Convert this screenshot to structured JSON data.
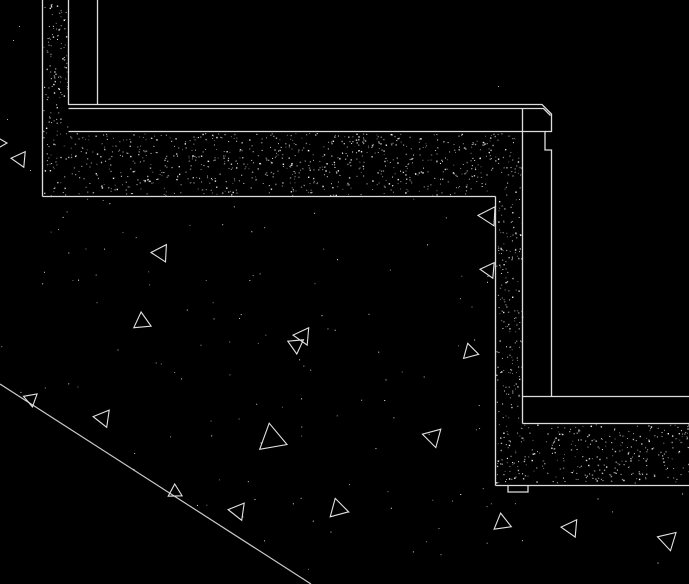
{
  "meta": {
    "app": "cad-detail-drawing",
    "description": "Concrete parapet / stepped retaining wall section detail on black CAD background",
    "canvas": {
      "width": 689,
      "height": 584
    }
  },
  "colors": {
    "background": "#000000",
    "line": "#dcdcdc",
    "grade_line": "#c9c9c9",
    "triangle": "#e2e2e2",
    "stipple": "#ffffff"
  },
  "drawing": {
    "seed": 1337,
    "outlines": [
      {
        "name": "wall-outer-face",
        "pts": [
          [
            42.5,
            0
          ],
          [
            42.5,
            196.5
          ]
        ]
      },
      {
        "name": "wall-inner-face",
        "pts": [
          [
            68.5,
            0
          ],
          [
            68.5,
            105
          ]
        ]
      },
      {
        "name": "finish-face-line",
        "pts": [
          [
            97.5,
            0
          ],
          [
            97.5,
            105
          ]
        ]
      },
      {
        "name": "coping-top-outer",
        "pts": [
          [
            68.5,
            104.5
          ],
          [
            542,
            104.5
          ],
          [
            551.5,
            114
          ],
          [
            551.5,
            131.5
          ],
          [
            545,
            131.5
          ]
        ]
      },
      {
        "name": "coping-top-inner",
        "pts": [
          [
            68.5,
            108.5
          ],
          [
            543.5,
            108.5
          ],
          [
            550.5,
            115.5
          ]
        ]
      },
      {
        "name": "coping-underside-drip",
        "pts": [
          [
            68.5,
            131.5
          ],
          [
            545,
            131.5
          ],
          [
            545,
            150
          ],
          [
            551.5,
            150
          ],
          [
            551.5,
            396.5
          ]
        ]
      },
      {
        "name": "upper-band-bottom",
        "pts": [
          [
            42.5,
            196.5
          ],
          [
            495.5,
            196.5
          ]
        ]
      },
      {
        "name": "lower-wall-left-face",
        "pts": [
          [
            495.5,
            196.5
          ],
          [
            495.5,
            485.5
          ]
        ]
      },
      {
        "name": "lower-wall-right-line",
        "pts": [
          [
            522.5,
            109
          ],
          [
            522.5,
            423.5
          ]
        ]
      },
      {
        "name": "terrace-finish-top",
        "pts": [
          [
            522.5,
            396.5
          ],
          [
            689,
            396.5
          ]
        ]
      },
      {
        "name": "terrace-concrete-top",
        "pts": [
          [
            522.5,
            423.5
          ],
          [
            689,
            423.5
          ]
        ]
      },
      {
        "name": "footing-bottom",
        "pts": [
          [
            495.5,
            485.5
          ],
          [
            689,
            485.5
          ]
        ]
      },
      {
        "name": "footing-key-notch",
        "pts": [
          [
            508,
            485.5
          ],
          [
            508,
            492
          ],
          [
            528,
            492
          ],
          [
            528,
            485.5
          ]
        ]
      }
    ],
    "grade_line": {
      "name": "grade-line",
      "pts": [
        [
          0,
          384
        ],
        [
          311,
          584
        ]
      ]
    },
    "stipple_regions": [
      {
        "name": "left-wall-hatch",
        "x": 43,
        "y": 1,
        "w": 25,
        "h": 195,
        "density": 0.03
      },
      {
        "name": "upper-slab-hatch",
        "x": 69,
        "y": 133,
        "w": 453,
        "h": 62,
        "density": 0.03
      },
      {
        "name": "right-wall-hatch",
        "x": 496,
        "y": 197,
        "w": 26,
        "h": 225,
        "density": 0.03
      },
      {
        "name": "lower-footing-hatch",
        "x": 496,
        "y": 424,
        "w": 193,
        "h": 59,
        "density": 0.03
      }
    ],
    "soil_scatter": {
      "polygon": [
        [
          0,
          197
        ],
        [
          495,
          197
        ],
        [
          495,
          485
        ],
        [
          689,
          485
        ],
        [
          689,
          584
        ],
        [
          311,
          584
        ],
        [
          0,
          385
        ]
      ],
      "count": 130
    },
    "extra_dots": [
      [
        19,
        26
      ],
      [
        13,
        40
      ],
      [
        7,
        119
      ],
      [
        30,
        170
      ],
      [
        498,
        86
      ]
    ],
    "triangles": [
      {
        "cx": -2,
        "cy": 143,
        "r": 9,
        "rot": 0
      },
      {
        "cx": 20,
        "cy": 159,
        "r": 9,
        "rot": 185
      },
      {
        "cx": 161,
        "cy": 253,
        "r": 10,
        "rot": 183
      },
      {
        "cx": 142,
        "cy": 322,
        "r": 10,
        "rot": 265
      },
      {
        "cx": 303,
        "cy": 336,
        "r": 10,
        "rot": 185
      },
      {
        "cx": 296,
        "cy": 345,
        "r": 9,
        "rot": 205
      },
      {
        "cx": 470,
        "cy": 352,
        "r": 9,
        "rot": 255
      },
      {
        "cx": 489,
        "cy": 216,
        "r": 11,
        "rot": 183
      },
      {
        "cx": 489,
        "cy": 270,
        "r": 9,
        "rot": 185
      },
      {
        "cx": 31,
        "cy": 399,
        "r": 8,
        "rot": 200
      },
      {
        "cx": 103,
        "cy": 418,
        "r": 10,
        "rot": 188
      },
      {
        "cx": 175,
        "cy": 492,
        "r": 8,
        "rot": 268
      },
      {
        "cx": 238,
        "cy": 511,
        "r": 10,
        "rot": 188
      },
      {
        "cx": 338,
        "cy": 509,
        "r": 11,
        "rot": 255
      },
      {
        "cx": 272,
        "cy": 439,
        "r": 16,
        "rot": 260
      },
      {
        "cx": 433,
        "cy": 437,
        "r": 11,
        "rot": 195
      },
      {
        "cx": 502,
        "cy": 523,
        "r": 10,
        "rot": 262
      },
      {
        "cx": 571,
        "cy": 528,
        "r": 10,
        "rot": 185
      },
      {
        "cx": 668,
        "cy": 540,
        "r": 11,
        "rot": 197
      }
    ]
  }
}
